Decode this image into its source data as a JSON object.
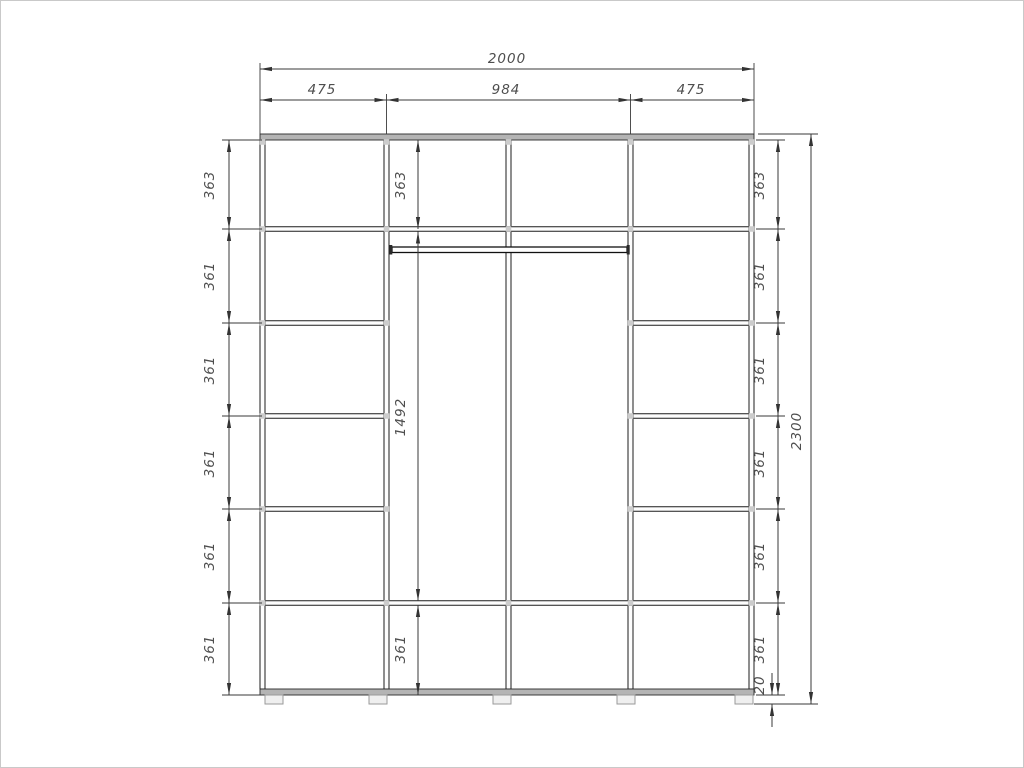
{
  "drawing": {
    "kind": "wardrobe-front-elevation-dimension-drawing",
    "units": "mm",
    "colors": {
      "object_line": "#1d1d1d",
      "dimension_line": "#3a3a3a",
      "dimension_text": "#4e4e4e",
      "panel_band": "#b4b4b4",
      "background": "#ffffff"
    },
    "dims": {
      "total_width": "2000",
      "left_width": "475",
      "center_width": "984",
      "right_width": "475",
      "total_height": "2300",
      "plinth_height": "20",
      "left_sections": [
        "363",
        "361",
        "361",
        "361",
        "361",
        "361"
      ],
      "center_sections": {
        "top": "363",
        "middle": "1492",
        "bottom": "361"
      },
      "right_sections": [
        "363",
        "361",
        "361",
        "361",
        "361",
        "361"
      ]
    }
  }
}
